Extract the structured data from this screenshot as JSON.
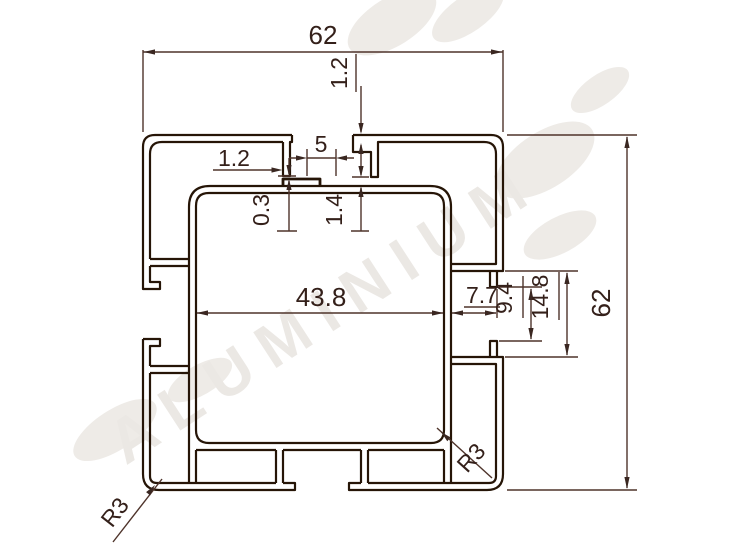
{
  "drawing": {
    "title": "aluminium-profile-cross-section",
    "units": "mm",
    "dimensions": {
      "top_width": "62",
      "right_height": "62",
      "top_wall_thickness": "1.2",
      "lip_width": "1.2",
      "slot_opening": "5",
      "lip_clearance": "0.3",
      "rib_clearance": "1.4",
      "cavity_width": "43.8",
      "notch_depth": "7.7",
      "notch_lip_span": "9.4",
      "notch_height": "14.8",
      "radius_bottom_left": "R3",
      "radius_bottom_right": "R3"
    },
    "watermark_text": "ALUMINIUM",
    "colors": {
      "profile_line": "#261507",
      "dimension_line": "#4e332a",
      "text": "#34201a",
      "watermark": "#ebe8e4",
      "background": "#ffffff"
    }
  }
}
